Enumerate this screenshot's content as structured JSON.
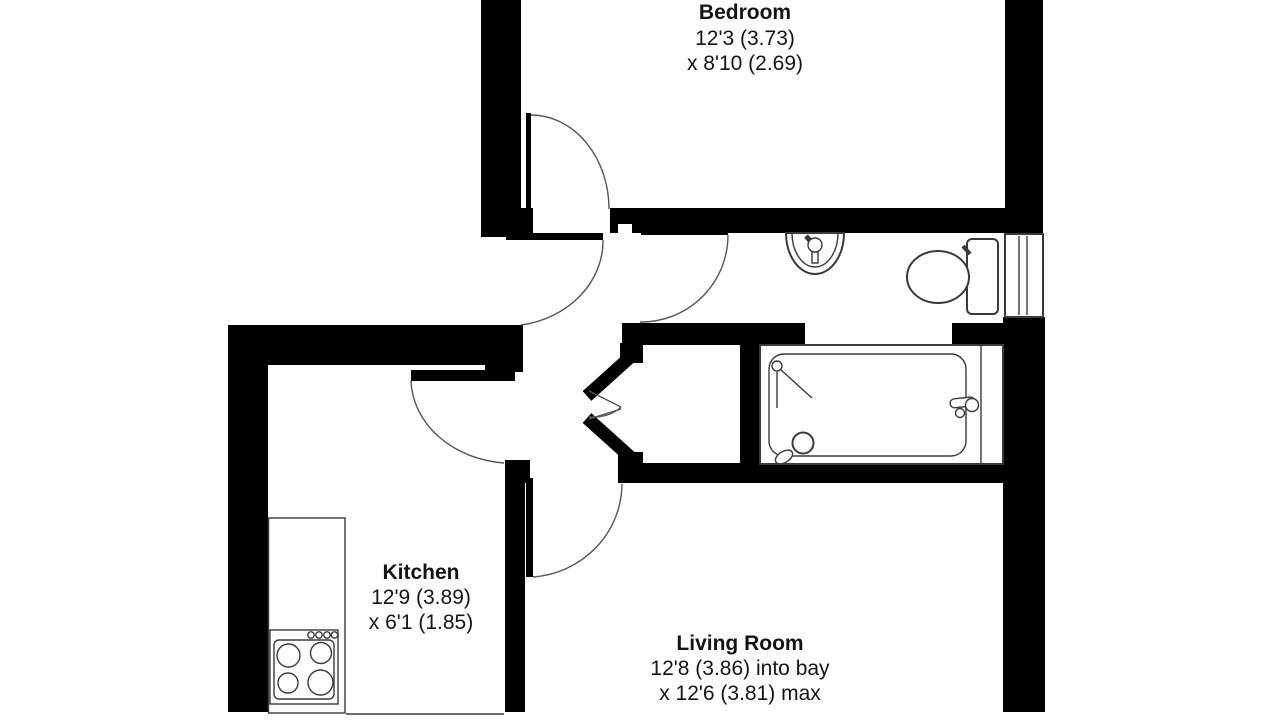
{
  "title": "Flat floor plan",
  "colors": {
    "background": "#ffffff",
    "walls": "#000000",
    "fixture_lines": "#3a3a3a",
    "arc_lines": "#555555",
    "text": "#141414"
  },
  "rooms": [
    {
      "name": "Bedroom",
      "size_line_1": "12'3 (3.73)",
      "size_line_2": "x 8'10 (2.69)"
    },
    {
      "name": "Kitchen",
      "size_line_1": "12'9 (3.89)",
      "size_line_2": "x 6'1 (1.85)"
    },
    {
      "name": "Living Room",
      "size_line_1": "12'8 (3.86) into bay",
      "size_line_2": "x 12'6 (3.81) max"
    }
  ],
  "fixtures": [
    {
      "icon": "wash-basin-icon",
      "room": "bathroom"
    },
    {
      "icon": "toilet-icon",
      "room": "bathroom"
    },
    {
      "icon": "bathtub-icon",
      "room": "bathroom"
    },
    {
      "icon": "shower-head-icon",
      "room": "bathroom"
    },
    {
      "icon": "window-icon",
      "room": "bathroom"
    },
    {
      "icon": "kitchen-counter-icon",
      "room": "kitchen"
    },
    {
      "icon": "cooker-hob-icon",
      "room": "kitchen"
    },
    {
      "icon": "door-swing-icon",
      "room": "bedroom"
    },
    {
      "icon": "door-swing-icon",
      "room": "entrance-hall"
    },
    {
      "icon": "door-swing-icon",
      "room": "bathroom"
    },
    {
      "icon": "door-swing-icon",
      "room": "kitchen"
    },
    {
      "icon": "door-swing-icon",
      "room": "living-room"
    },
    {
      "icon": "bifold-door-icon",
      "room": "cupboard"
    }
  ]
}
